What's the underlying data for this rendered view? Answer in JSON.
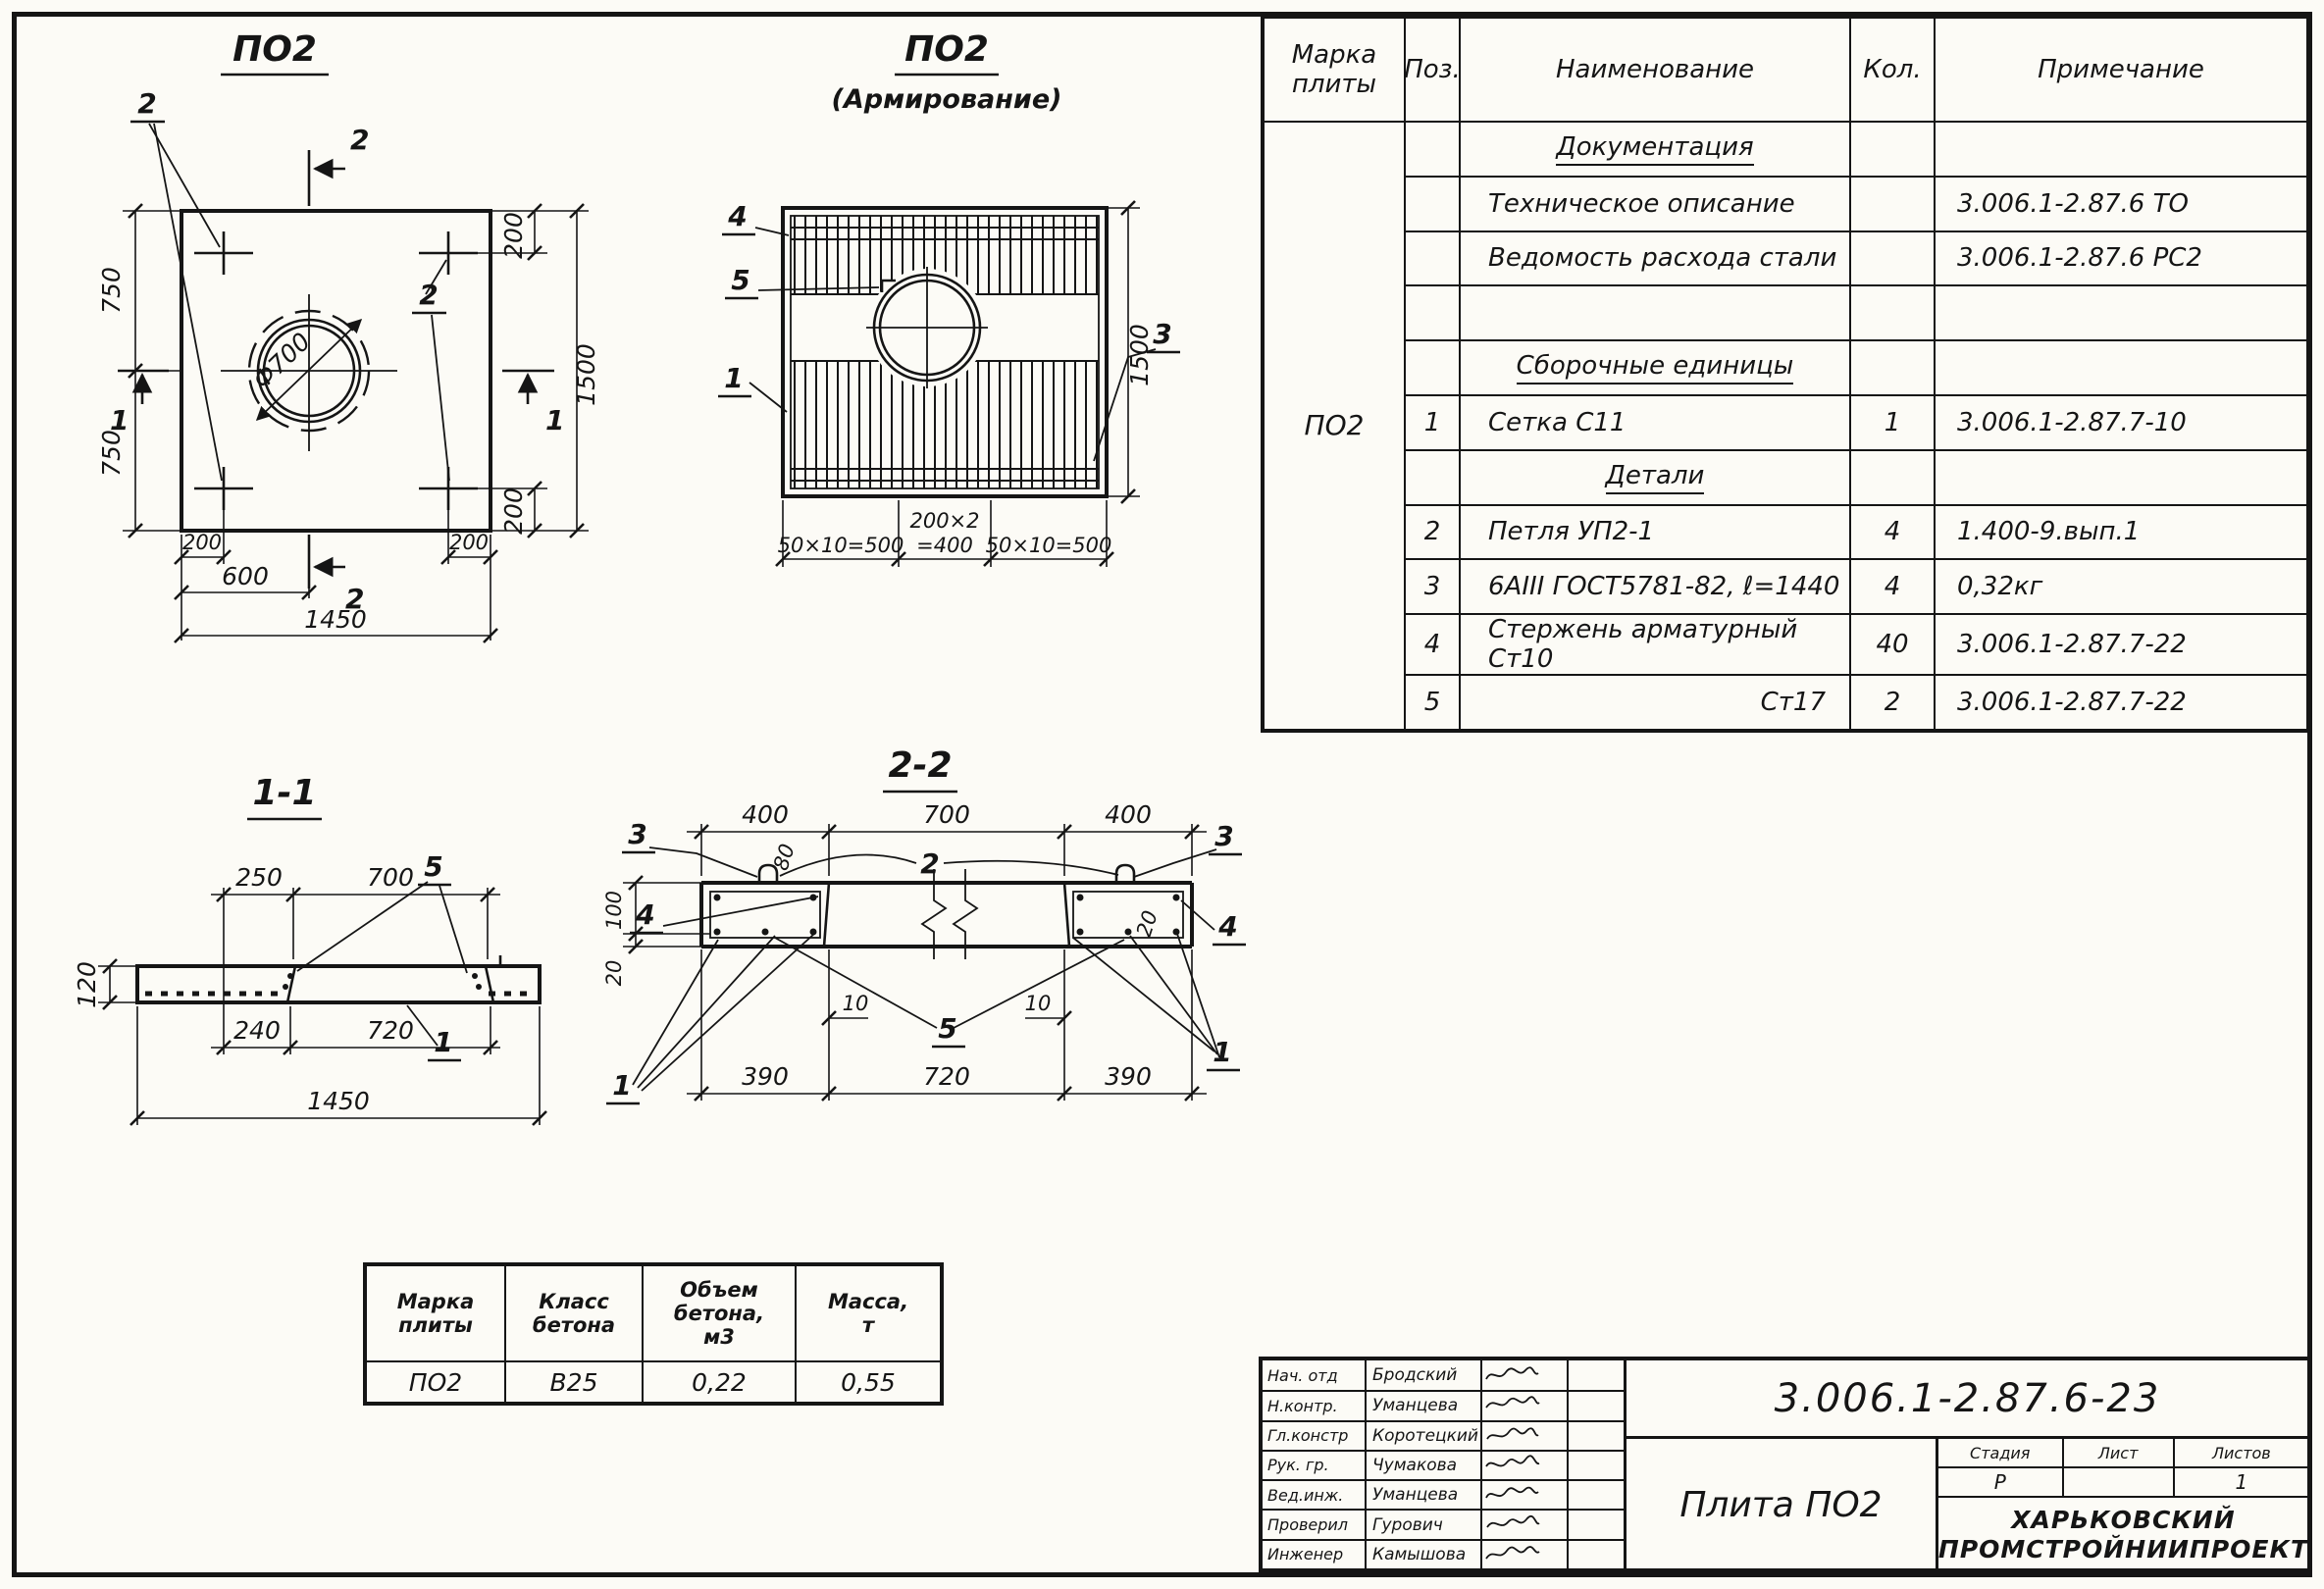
{
  "plan": {
    "title": "ПО2",
    "loop_label_left": "2",
    "loop_label_right": "2",
    "cut2_top": "2",
    "cut2_bottom": "2",
    "cut1_left": "1",
    "cut1_right": "1",
    "dim_left_top": "750",
    "dim_left_bottom": "750",
    "dim_right_overall": "1500",
    "dim_right_top": "200",
    "dim_right_bottom": "200",
    "dim_bottom_left_200": "200",
    "dim_bottom_right_200": "200",
    "dim_bottom_600": "600",
    "dim_bottom_overall": "1450",
    "hole_diameter": "Ф700"
  },
  "reinf": {
    "title": "ПО2",
    "subtitle": "(Армирование)",
    "mark_4": "4",
    "mark_5": "5",
    "mark_1": "1",
    "mark_3": "3",
    "dim_right_overall": "1500",
    "dim_bottom_left": "50×10=500",
    "dim_bottom_center_top": "200×2",
    "dim_bottom_center_bottom": "=400",
    "dim_bottom_right": "50×10=500"
  },
  "sec11": {
    "title": "1-1",
    "mark_5": "5",
    "mark_1": "1",
    "dim_top_250": "250",
    "dim_top_700": "700",
    "dim_left_120": "120",
    "dim_bottom_240": "240",
    "dim_bottom_720": "720",
    "dim_bottom_overall": "1450"
  },
  "sec22": {
    "title": "2-2",
    "mark_3_left": "3",
    "mark_2": "2",
    "mark_3_right": "3",
    "mark_4_left": "4",
    "mark_4_right": "4",
    "mark_5": "5",
    "mark_1_left": "1",
    "mark_1_right": "1",
    "dim_top_400_left": "400",
    "dim_top_700": "700",
    "dim_top_400_right": "400",
    "dim_left_100": "100",
    "dim_left_20": "20",
    "dim_hook_80": "80",
    "dim_cover_20": "20",
    "dim_10_left": "10",
    "dim_10_right": "10",
    "dim_bottom_390_left": "390",
    "dim_bottom_720": "720",
    "dim_bottom_390_right": "390"
  },
  "spec": {
    "header": {
      "mark": "Марка\nплиты",
      "pos": "Поз.",
      "name": "Наименование",
      "qty": "Кол.",
      "note": "Примечание"
    },
    "mark_value": "ПО2",
    "rows": [
      {
        "pos": "",
        "name": "Документация",
        "qty": "",
        "note": ""
      },
      {
        "pos": "",
        "name": "Техническое описание",
        "qty": "",
        "note": "3.006.1-2.87.6 ТО"
      },
      {
        "pos": "",
        "name": "Ведомость расхода стали",
        "qty": "",
        "note": "3.006.1-2.87.6 РС2"
      },
      {
        "pos": "",
        "name": "",
        "qty": "",
        "note": ""
      },
      {
        "pos": "",
        "name": "Сборочные единицы",
        "qty": "",
        "note": ""
      },
      {
        "pos": "1",
        "name": "Сетка С11",
        "qty": "1",
        "note": "3.006.1-2.87.7-10"
      },
      {
        "pos": "",
        "name": "Детали",
        "qty": "",
        "note": ""
      },
      {
        "pos": "2",
        "name": "Петля УП2-1",
        "qty": "4",
        "note": "1.400-9.вып.1"
      },
      {
        "pos": "3",
        "name": "6АIII ГОСТ5781-82, ℓ=1440",
        "qty": "4",
        "note": "0,32кг"
      },
      {
        "pos": "4",
        "name": "Стержень арматурный Ст10",
        "qty": "40",
        "note": "3.006.1-2.87.7-22"
      },
      {
        "pos": "5",
        "name": "Ст17",
        "qty": "2",
        "note": "3.006.1-2.87.7-22"
      }
    ]
  },
  "material": {
    "header_mark": "Марка\nплиты",
    "header_class": "Класс\nбетона",
    "header_volume": "Объем\nбетона,\nм3",
    "header_mass": "Масса,\nт",
    "value_mark": "ПО2",
    "value_class": "В25",
    "value_volume": "0,22",
    "value_mass": "0,55"
  },
  "titleblock": {
    "doc_number": "3.006.1-2.87.6-23",
    "drawing_title": "Плита ПО2",
    "stage_label": "Стадия",
    "sheet_label": "Лист",
    "sheets_label": "Листов",
    "stage_value": "Р",
    "sheet_value": "",
    "sheets_value": "1",
    "org_line1": "ХАРЬКОВСКИЙ",
    "org_line2": "ПРОМСТРОЙНИИПРОЕКТ",
    "signatures": [
      {
        "role": "Нач. отд",
        "name": "Бродский"
      },
      {
        "role": "Н.контр.",
        "name": "Уманцева"
      },
      {
        "role": "Гл.констр",
        "name": "Коротецкий"
      },
      {
        "role": "Рук. гр.",
        "name": "Чумакова"
      },
      {
        "role": "Вед.инж.",
        "name": "Уманцева"
      },
      {
        "role": "Проверил",
        "name": "Гурович"
      },
      {
        "role": "Инженер",
        "name": "Камышова"
      }
    ]
  }
}
